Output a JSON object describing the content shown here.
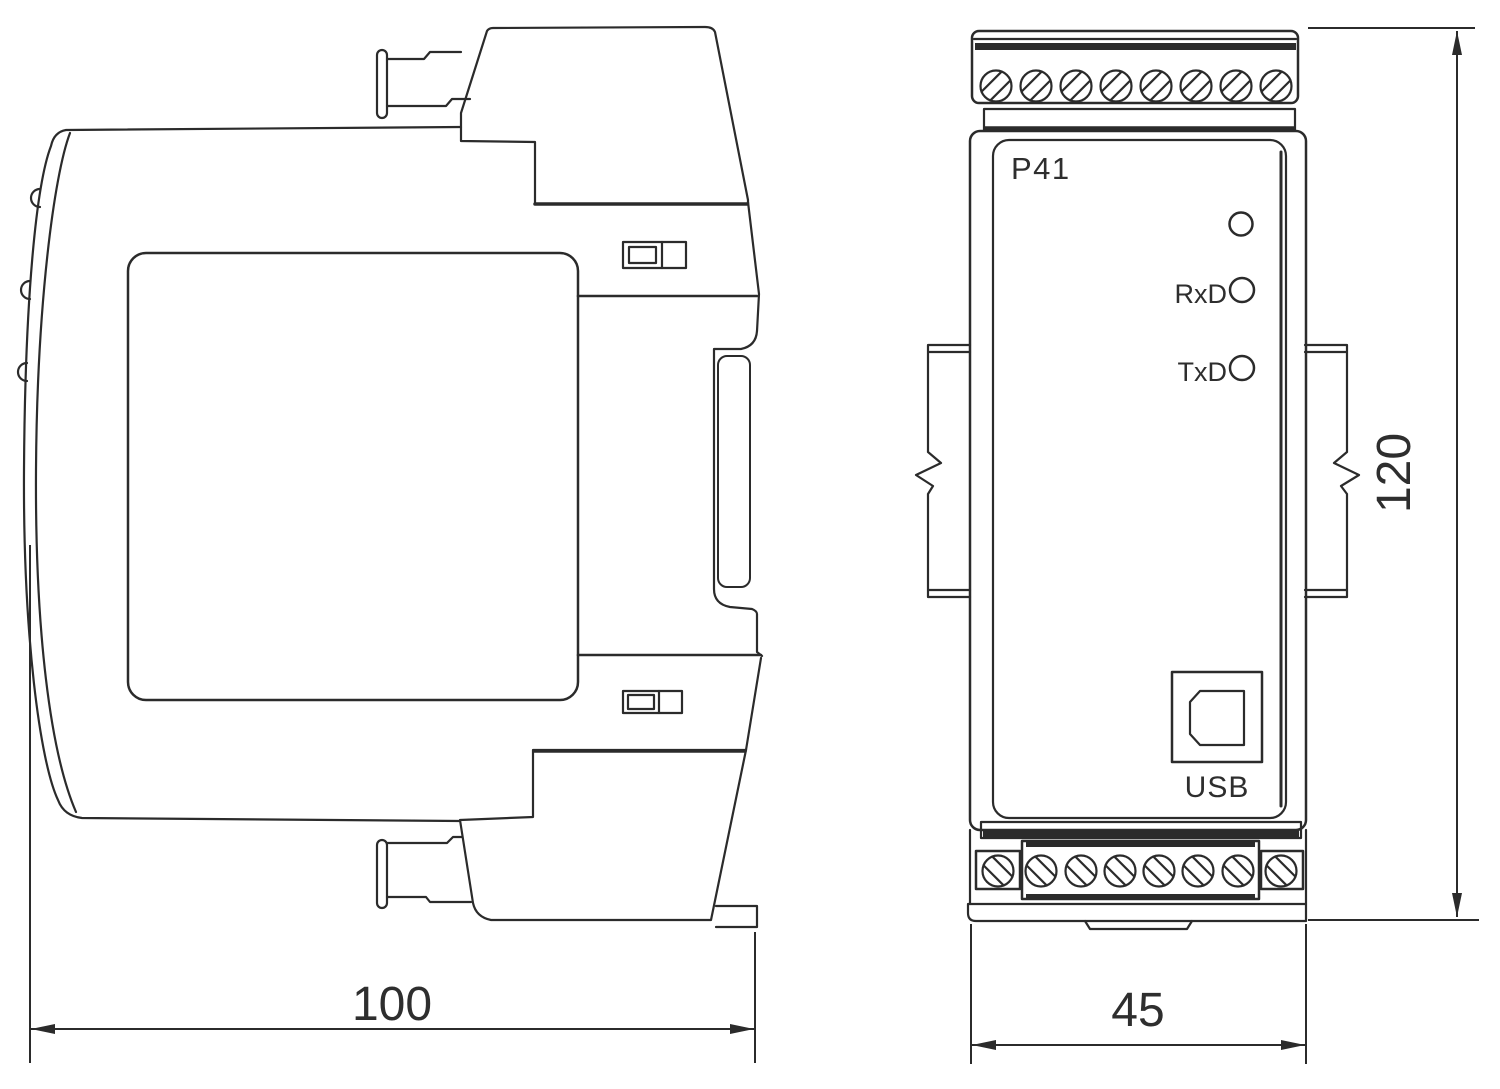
{
  "drawing": {
    "front_view": {
      "model_label": "P41",
      "rxd_label": "RxD",
      "txd_label": "TxD",
      "usb_label": "USB"
    },
    "dimensions": {
      "side_width_label": "100",
      "front_width_label": "45",
      "height_label": "120"
    },
    "screw_rows": [
      {
        "id": "top-terminal-screws",
        "cy": 86,
        "r": 15.5,
        "hatch": "/",
        "cx": [
          996,
          1036,
          1076,
          1116,
          1156,
          1196,
          1236,
          1276
        ]
      },
      {
        "id": "bottom-terminal-screws",
        "cy": 871,
        "r": 15.5,
        "hatch": "\\",
        "cx": [
          998,
          1041,
          1081,
          1120,
          1159,
          1198,
          1238,
          1281
        ]
      }
    ],
    "colors": {
      "line": "#2b2b2b",
      "text": "#2e2e2e",
      "background": "#ffffff"
    }
  }
}
